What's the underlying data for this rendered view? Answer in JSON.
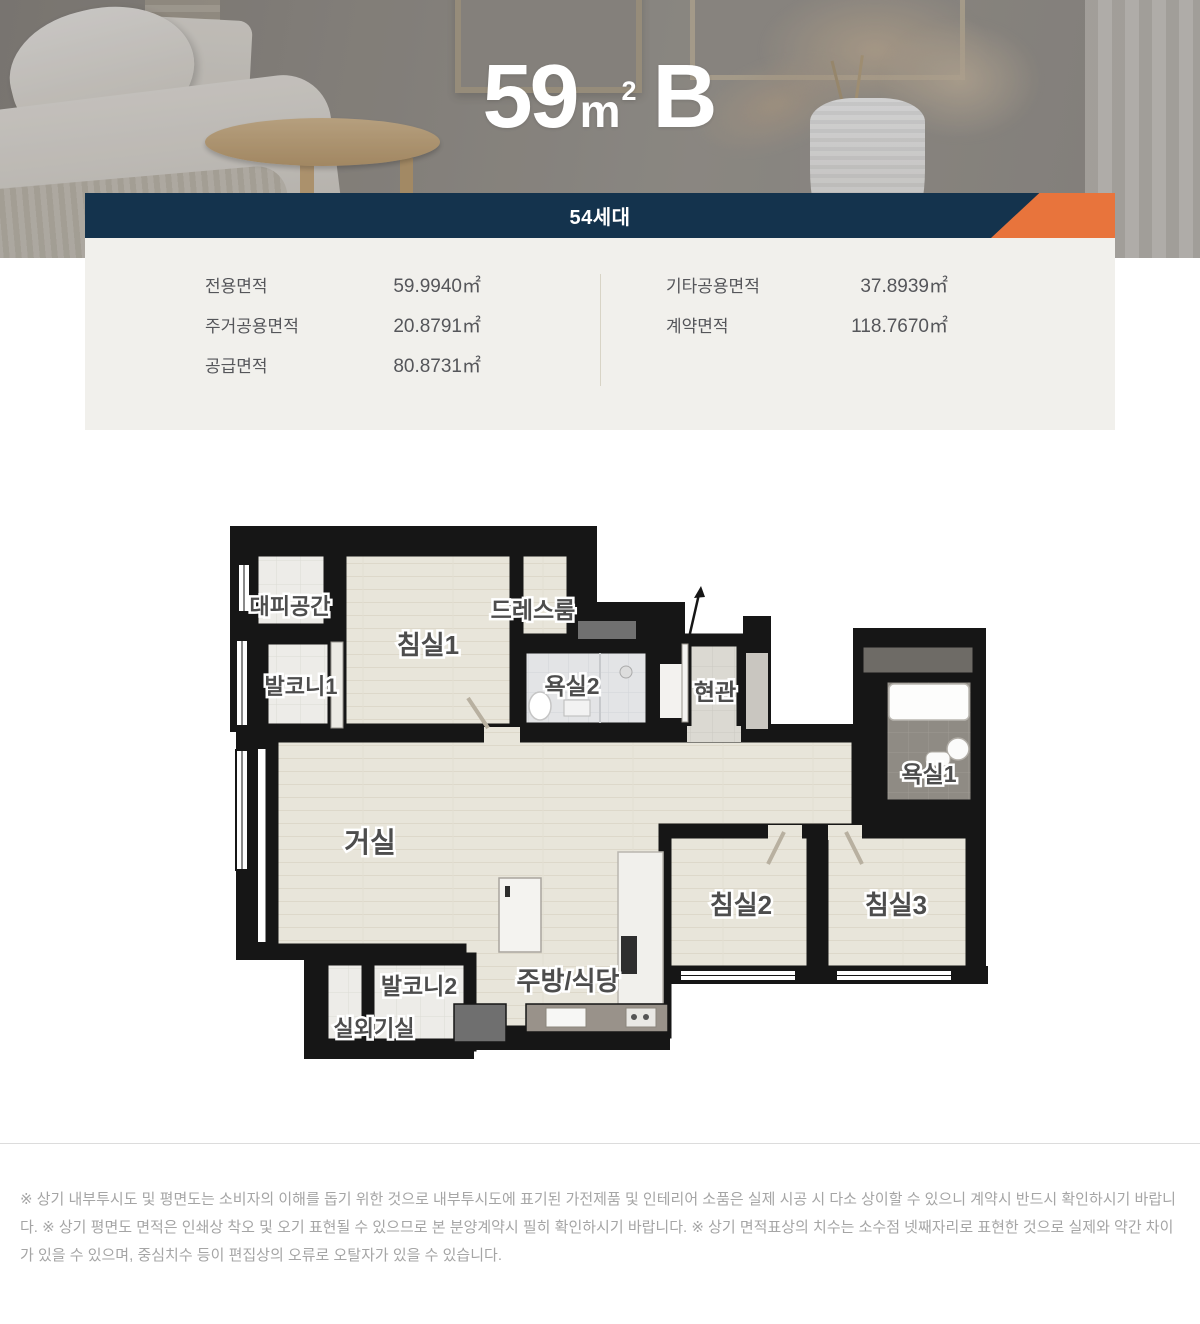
{
  "colors": {
    "navy": "#14334d",
    "orange": "#e8743c",
    "panel_bg": "#f1f0ec",
    "wall": "#161616"
  },
  "hero": {
    "title_number": "59",
    "title_unit": "m",
    "title_sup": "2",
    "title_suffix": "B"
  },
  "banner": {
    "label": "54세대"
  },
  "area_info": {
    "left": [
      {
        "label": "전용면적",
        "value": "59.9940㎡"
      },
      {
        "label": "주거공용면적",
        "value": "20.8791㎡"
      },
      {
        "label": "공급면적",
        "value": "80.8731㎡"
      }
    ],
    "right": [
      {
        "label": "기타공용면적",
        "value": "37.8939㎡"
      },
      {
        "label": "계약면적",
        "value": "118.7670㎡"
      }
    ]
  },
  "floor_plan": {
    "rooms": [
      {
        "label": "대피공간"
      },
      {
        "label": "발코니1"
      },
      {
        "label": "침실1"
      },
      {
        "label": "드레스룸"
      },
      {
        "label": "욕실2"
      },
      {
        "label": "현관"
      },
      {
        "label": "욕실1"
      },
      {
        "label": "거실"
      },
      {
        "label": "주방/식당"
      },
      {
        "label": "발코니2"
      },
      {
        "label": "실외기실"
      },
      {
        "label": "침실2"
      },
      {
        "label": "침실3"
      }
    ]
  },
  "footer": {
    "disclaimer": "※ 상기 내부투시도 및 평면도는 소비자의 이해를 돕기 위한 것으로 내부투시도에 표기된 가전제품 및 인테리어 소품은 실제 시공 시 다소 상이할 수 있으니 계약시 반드시 확인하시기 바랍니다. ※ 상기 평면도 면적은 인쇄상 착오 및 오기 표현될 수 있으므로 본 분양계약시 필히 확인하시기 바랍니다. ※ 상기 면적표상의 치수는 소수점 넷째자리로 표현한 것으로 실제와 약간 차이가 있을 수 있으며, 중심치수 등이 편집상의 오류로 오탈자가 있을 수 있습니다."
  }
}
